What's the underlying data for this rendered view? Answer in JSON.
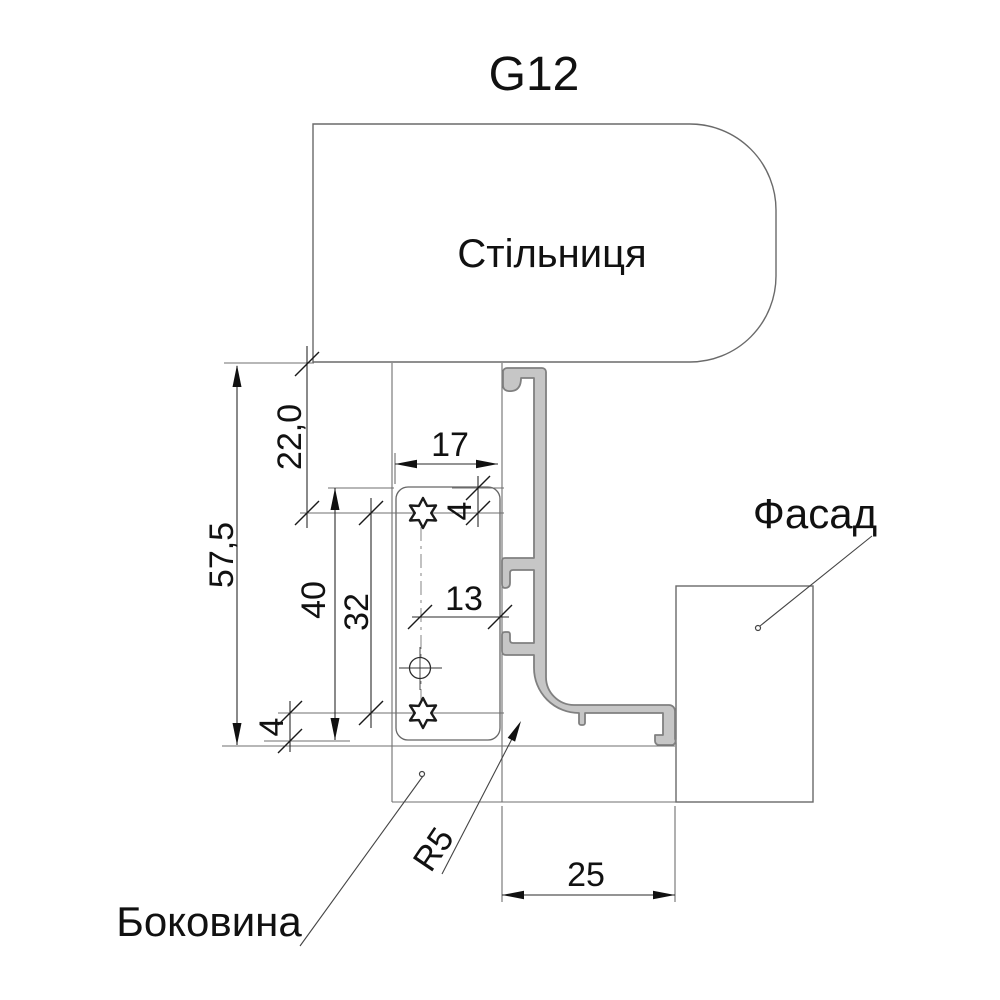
{
  "drawing": {
    "title": "G12",
    "labels": {
      "countertop": "Стільниця",
      "facade": "Фасад",
      "side_panel": "Боковина"
    },
    "dimensions": {
      "total_height": "57,5",
      "countertop_to_screw": "22,0",
      "plate_length": "40",
      "screw_spacing": "32",
      "screw_offset_top": "4",
      "plate_width": "17",
      "hole_to_front": "13",
      "screw_offset_bottom": "4",
      "front_depth": "25",
      "bend_radius": "R5"
    },
    "colors": {
      "background": "#ffffff",
      "profile_fill": "#c6c6c6",
      "profile_stroke": "#808080",
      "outline": "#6a6a6a",
      "dimension": "#1a1a1a"
    }
  }
}
